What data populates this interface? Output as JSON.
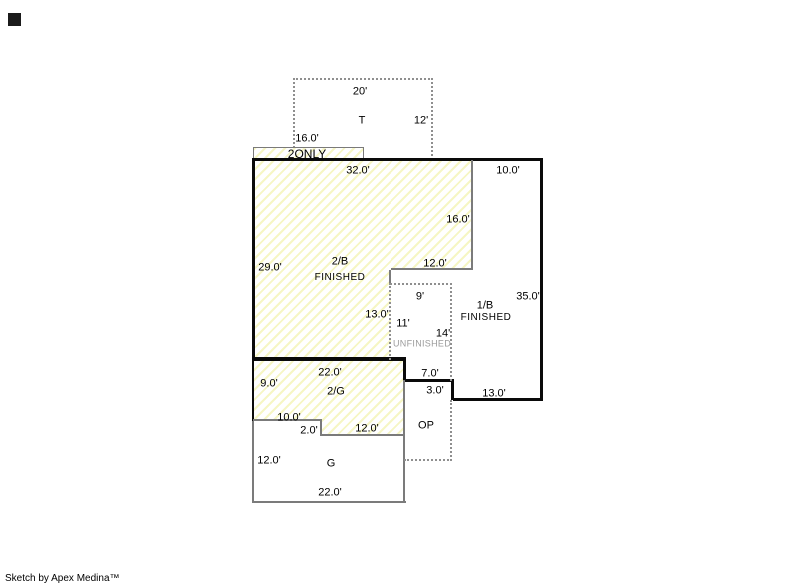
{
  "attribution": "Sketch by Apex Medina™",
  "colors": {
    "hatch_stripe": "#f6f6c4",
    "line_black": "#0a0a0a",
    "line_gray": "#7b7b7b",
    "line_dotted": "#8f8f8f",
    "unfinished_text": "#9b9b9b",
    "corner_marker": "#1b1b1b"
  },
  "areas": {
    "t": {
      "label": "T",
      "dim_top": "20'",
      "dim_right": "12'"
    },
    "second_floor_strip": {
      "label": "2ONLY",
      "dim_top": "16.0'"
    },
    "second_basement": {
      "label": "2/B",
      "status": "FINISHED",
      "dim_top": "32.0'",
      "dim_left": "29.0'",
      "dim_right": "16.0'",
      "dim_step": "12.0'",
      "dim_lower_right": "13.0'"
    },
    "first_basement": {
      "label": "1/B",
      "status": "FINISHED",
      "dim_top": "10.0'",
      "dim_right": "35.0'",
      "dim_bottom": "13.0'"
    },
    "unfinished": {
      "label": "UNFINISHED",
      "dim_top": "9'",
      "dim_left": "11'",
      "dim_right": "14'"
    },
    "second_garage": {
      "label": "2/G",
      "dim_top": "22.0'",
      "dim_left": "9.0'",
      "dim_step_top": "10.0'",
      "dim_step_side": "2.0'",
      "dim_bottom": "12.0'"
    },
    "open_porch": {
      "label": "OP",
      "dim_top": "7.0'",
      "dim_side": "3.0'"
    },
    "garage": {
      "label": "G",
      "dim_left": "12.0'",
      "dim_bottom": "22.0'"
    }
  }
}
